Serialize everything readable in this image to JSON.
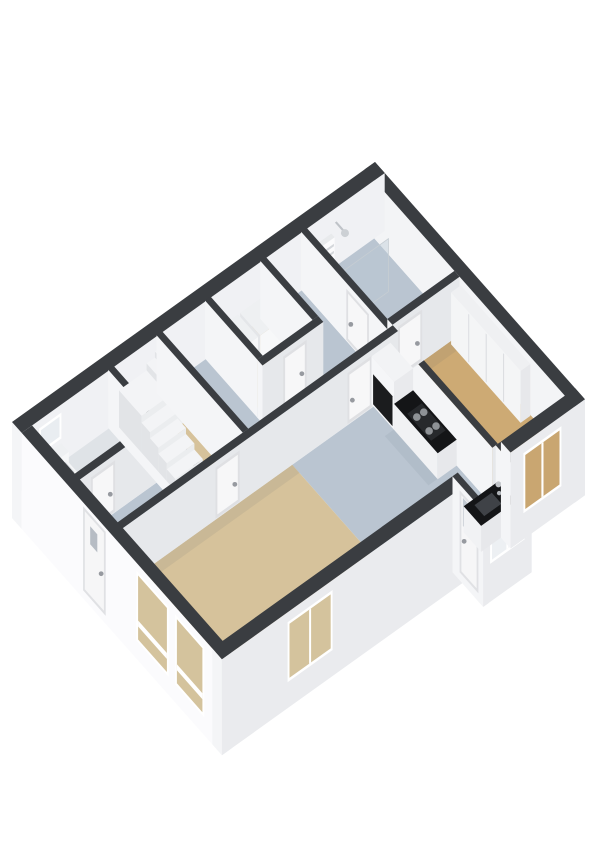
{
  "meta": {
    "label": "3D floor plan, isometric view"
  },
  "projection": {
    "ox": 12,
    "oy": 422,
    "ax": 34.57,
    "ay": -24.76,
    "bx": 32.3,
    "by": 36.5,
    "floor": 58,
    "ground": 96
  },
  "colors": {
    "background": "#ffffff",
    "wallTop": "#3a3d41",
    "faceL": "#f4f5f7",
    "faceR": "#e6e8eb",
    "exteriorWhite": "#fbfbfd",
    "floorWood": "#d6c29b",
    "floorWoodDark": "#cdaa74",
    "floorBlueGray": "#bac5d1",
    "floorGray": "#dfe3e7",
    "counterBlack": "#141517",
    "applianceBlack": "#1b1c1e",
    "glassTan": "#d4c39d",
    "glassTanDark": "#c9a671",
    "glassWhite": "#edf0f3",
    "doorPanel": "#f7f7f8",
    "doorFrame": "#dfe0e3",
    "windowFrame": "#ffffff",
    "handle": "#979aa0"
  },
  "items": [
    {
      "t": "flat",
      "n": "floor-wc",
      "u0": 0.28,
      "v0": 0.28,
      "u1": 2.52,
      "v1": 1.62,
      "dy": 58,
      "f": "#dfe3e7"
    },
    {
      "t": "flat",
      "n": "floor-entry",
      "u0": 0.28,
      "v0": 1.78,
      "u1": 2.52,
      "v1": 2.95,
      "dy": 58,
      "f": "#bac5d1"
    },
    {
      "t": "flat",
      "n": "floor-stairwell",
      "u0": 2.68,
      "v0": 0.28,
      "u1": 3.92,
      "v1": 2.95,
      "dy": 58,
      "f": "#d6c29b"
    },
    {
      "t": "flat",
      "n": "floor-hall",
      "u0": 4.08,
      "v0": 0.28,
      "u1": 8.1,
      "v1": 2.95,
      "dy": 58,
      "f": "#bac5d1"
    },
    {
      "t": "flat",
      "n": "floor-utility",
      "u0": 5.48,
      "v0": 0.28,
      "u1": 6.92,
      "v1": 1.9,
      "dy": 58,
      "f": "#d6c29b"
    },
    {
      "t": "flat",
      "n": "floor-bathroom",
      "u0": 8.26,
      "v0": 0.28,
      "u1": 10.2,
      "v1": 2.78,
      "dy": 58,
      "f": "#bac5d1"
    },
    {
      "t": "flat",
      "n": "floor-kitchen",
      "u0": 5.2,
      "v0": 3.11,
      "u1": 8.1,
      "v1": 6.2,
      "dy": 58,
      "f": "#bac5d1"
    },
    {
      "t": "flat",
      "n": "floor-sink-bay",
      "u0": 7.1,
      "v0": 6.2,
      "u1": 8.2,
      "v1": 6.85,
      "dy": 58,
      "f": "#bac5d1"
    },
    {
      "t": "flat",
      "n": "floor-living",
      "u0": 0.28,
      "v0": 3.11,
      "u1": 5.2,
      "v1": 6.2,
      "dy": 58,
      "f": "#d6c29b"
    },
    {
      "t": "flat",
      "n": "floor-bedroom",
      "u0": 8.26,
      "v0": 2.94,
      "u1": 10.2,
      "v1": 6.2,
      "dy": 58,
      "f": "#cdaa74"
    },
    {
      "t": "flat",
      "n": "shadow-living-north",
      "u0": 0.28,
      "v0": 3.11,
      "u1": 5.2,
      "v1": 3.34,
      "dy": 57.5,
      "f": "rgba(75,85,105,0.09)"
    },
    {
      "t": "flat",
      "n": "shadow-bedroom-north",
      "u0": 8.26,
      "v0": 2.94,
      "u1": 10.2,
      "v1": 3.18,
      "dy": 57.5,
      "f": "rgba(75,85,105,0.09)"
    },
    {
      "t": "flat",
      "n": "shadow-bath-west",
      "u0": 8.26,
      "v0": 0.28,
      "u1": 8.48,
      "v1": 2.78,
      "dy": 57.5,
      "f": "rgba(75,85,105,0.07)"
    },
    {
      "t": "flat",
      "n": "shadow-kitchen-counter",
      "u0": 7.28,
      "v0": 3.75,
      "u1": 7.55,
      "v1": 5.1,
      "dy": 57.5,
      "f": "rgba(75,85,105,0.07)"
    },
    {
      "t": "box",
      "n": "wall-ne",
      "u0": 10.2,
      "v0": 0,
      "u1": 10.5,
      "v1": 6.5,
      "bl": 58,
      "br": 96,
      "cl": "#f3f4f6"
    },
    {
      "t": "box",
      "n": "wall-nw",
      "u0": 0,
      "v0": 0,
      "u1": 10.5,
      "v1": 0.3,
      "bl": 96,
      "br": 58,
      "cr": "#f0f1f4"
    },
    {
      "t": "fV",
      "n": "window-wc",
      "v": 0.3,
      "a0": 0.5,
      "a1": 1.15,
      "y0": 8,
      "y1": 34,
      "fr": "#ffffff",
      "f": "#e9edf1"
    },
    {
      "t": "flat",
      "n": "shower-arm",
      "u0": 9.06,
      "v0": 0.3,
      "u1": 9.11,
      "v1": 0.54,
      "dy": 14,
      "f": "#bfc3c8"
    },
    {
      "t": "dot",
      "n": "shower-head",
      "u": 9.09,
      "v": 0.58,
      "dy": 15,
      "r": 4,
      "f": "#ccd0d4"
    },
    {
      "t": "box",
      "n": "toilet-cistern",
      "u0": 0.55,
      "v0": 0.34,
      "u1": 1.1,
      "v1": 0.58,
      "top": 36,
      "bl": 54,
      "br": 54,
      "ct": "#eef0f2",
      "cl": "#e3e5e8",
      "cr": "#f6f7f8"
    },
    {
      "t": "box",
      "n": "toilet-bowl",
      "u0": 0.62,
      "v0": 0.58,
      "u1": 1.03,
      "v1": 0.94,
      "top": 42,
      "bl": 56,
      "br": 56,
      "ct": "#f4f5f6",
      "cl": "#e6e8ea",
      "cr": "#fbfbfc"
    },
    {
      "t": "flat",
      "n": "toilet-seat",
      "u0": 0.68,
      "v0": 0.62,
      "u1": 0.97,
      "v1": 0.9,
      "dy": 41.5,
      "f": "#d4d7db"
    },
    {
      "t": "box",
      "n": "wall-wc-south",
      "u0": 0.28,
      "v0": 1.62,
      "u1": 2.52,
      "v1": 1.78
    },
    {
      "t": "fV",
      "n": "door-wc",
      "v": 1.78,
      "a0": 0.62,
      "a1": 1.32,
      "y0": 6,
      "y1": 57,
      "fr": "#dfe0e3",
      "f": "#f7f7f8",
      "h": "e"
    },
    {
      "t": "box",
      "n": "wall-stairs-west",
      "u0": 2.52,
      "v0": 0.28,
      "u1": 2.68,
      "v1": 2.95
    },
    {
      "t": "box",
      "n": "dryer",
      "u0": 6.28,
      "v0": 0.34,
      "u1": 6.88,
      "v1": 0.96,
      "top": 34,
      "ct": "#eef0f2",
      "cl": "#e4e6e9",
      "cr": "#f7f8f9"
    },
    {
      "t": "box",
      "n": "washer",
      "u0": 5.62,
      "v0": 0.34,
      "u1": 6.22,
      "v1": 0.96,
      "top": 34,
      "ct": "#eef0f2",
      "cl": "#e4e6e9",
      "cr": "#f7f8f9"
    },
    {
      "t": "box",
      "n": "wall-utility-west",
      "u0": 5.32,
      "v0": 0.28,
      "u1": 5.48,
      "v1": 1.9
    },
    {
      "t": "box",
      "n": "wall-utility-east",
      "u0": 6.92,
      "v0": 0.28,
      "u1": 7.08,
      "v1": 1.9
    },
    {
      "t": "box",
      "n": "wall-utility-south",
      "u0": 5.32,
      "v0": 1.9,
      "u1": 7.08,
      "v1": 2.06
    },
    {
      "t": "fV",
      "n": "door-utility",
      "v": 2.06,
      "a0": 5.92,
      "a1": 6.6,
      "y0": 6,
      "y1": 57,
      "fr": "#dfe0e3",
      "f": "#f7f7f8",
      "h": "e"
    },
    {
      "t": "box",
      "n": "stair-winder-2",
      "u0": 3.76,
      "v0": 0.4,
      "u1": 4.0,
      "v1": 1.1,
      "top": 8,
      "ct": "#f3f4f6",
      "cl": "#e2e4e7",
      "cr": "#ebedef"
    },
    {
      "t": "box",
      "n": "stair-winder-1",
      "u0": 3.52,
      "v0": 0.4,
      "u1": 3.76,
      "v1": 1.1,
      "top": 14,
      "ct": "#f3f4f6",
      "cl": "#e2e4e7",
      "cr": "#ebedef"
    },
    {
      "t": "box",
      "n": "stair-landing",
      "u0": 2.72,
      "v0": 0.4,
      "u1": 3.52,
      "v1": 1.1,
      "top": 21,
      "ct": "#f3f4f6",
      "cl": "#e2e4e7",
      "cr": "#ebedef"
    },
    {
      "t": "box",
      "n": "stair-step-5",
      "u0": 2.72,
      "v0": 1.1,
      "u1": 3.52,
      "v1": 1.36,
      "top": 28,
      "ct": "#f3f4f6",
      "cl": "#e2e4e7",
      "cr": "#ebedef"
    },
    {
      "t": "box",
      "n": "stair-step-4",
      "u0": 2.72,
      "v0": 1.36,
      "u1": 3.52,
      "v1": 1.62,
      "top": 34,
      "ct": "#f3f4f6",
      "cl": "#e2e4e7",
      "cr": "#ebedef"
    },
    {
      "t": "box",
      "n": "stair-step-3",
      "u0": 2.72,
      "v0": 1.62,
      "u1": 3.52,
      "v1": 1.88,
      "top": 40,
      "ct": "#f3f4f6",
      "cl": "#e2e4e7",
      "cr": "#ebedef"
    },
    {
      "t": "box",
      "n": "stair-step-2",
      "u0": 2.72,
      "v0": 1.88,
      "u1": 3.52,
      "v1": 2.14,
      "top": 46,
      "ct": "#f3f4f6",
      "cl": "#e2e4e7",
      "cr": "#ebedef"
    },
    {
      "t": "box",
      "n": "stair-step-1",
      "u0": 2.72,
      "v0": 2.14,
      "u1": 3.52,
      "v1": 2.4,
      "top": 52,
      "ct": "#f3f4f6",
      "cl": "#e2e4e7",
      "cr": "#ebedef"
    },
    {
      "t": "box",
      "n": "wall-stairs-east",
      "u0": 3.92,
      "v0": 0.28,
      "u1": 4.08,
      "v1": 2.95
    },
    {
      "t": "box",
      "n": "towel-radiator",
      "u0": 8.32,
      "v0": 0.34,
      "u1": 8.92,
      "v1": 0.44,
      "top": 20,
      "bl": 54,
      "br": 54,
      "ct": "#e8eaec",
      "cl": "#eff0f2",
      "cr": "#fbfbfc"
    },
    {
      "t": "fV",
      "n": "radiator-rung-1",
      "v": 0.44,
      "a0": 8.34,
      "a1": 8.9,
      "y0": 26,
      "y1": 28.5,
      "f": "#d4d7db"
    },
    {
      "t": "fV",
      "n": "radiator-rung-2",
      "v": 0.44,
      "a0": 8.34,
      "a1": 8.9,
      "y0": 33,
      "y1": 35.5,
      "f": "#d4d7db"
    },
    {
      "t": "fV",
      "n": "radiator-rung-3",
      "v": 0.44,
      "a0": 8.34,
      "a1": 8.9,
      "y0": 40,
      "y1": 42.5,
      "f": "#d4d7db"
    },
    {
      "t": "fV",
      "n": "shower-glass",
      "v": 1.38,
      "a0": 8.34,
      "a1": 9.6,
      "y0": 4,
      "y1": 57,
      "f": "rgba(186,200,212,0.42)",
      "st": "#c6cdd3"
    },
    {
      "t": "box",
      "n": "wall-bath-west",
      "u0": 8.1,
      "v0": 0.28,
      "u1": 8.26,
      "v1": 6.2
    },
    {
      "t": "fU",
      "n": "door-bathroom",
      "u": 8.1,
      "a0": 1.68,
      "a1": 2.38,
      "y0": 6,
      "y1": 57,
      "fr": "#dfe0e3",
      "f": "#f7f7f8",
      "h": "s"
    },
    {
      "t": "box",
      "n": "wall-bedroom-north",
      "u0": 8.26,
      "v0": 2.78,
      "u1": 10.2,
      "v1": 2.94
    },
    {
      "t": "fV",
      "n": "door-bedroom",
      "v": 2.94,
      "a0": 8.42,
      "a1": 9.12,
      "y0": 6,
      "y1": 57,
      "fr": "#dfe0e3",
      "f": "#f7f7f8",
      "h": "e"
    },
    {
      "t": "box",
      "n": "wardrobe",
      "u0": 9.9,
      "v0": 3.0,
      "u1": 10.18,
      "v1": 5.15,
      "top": 6,
      "ct": "#eff0f2",
      "cl": "#f4f5f6",
      "cr": "#e7e8eb"
    },
    {
      "t": "fU",
      "n": "wardrobe-seam-1",
      "u": 9.9,
      "a0": 3.53,
      "a1": 3.56,
      "y0": 8,
      "y1": 56,
      "f": "#d9dbdf"
    },
    {
      "t": "fU",
      "n": "wardrobe-seam-2",
      "u": 9.9,
      "a0": 4.07,
      "a1": 4.1,
      "y0": 8,
      "y1": 56,
      "f": "#d9dbdf"
    },
    {
      "t": "fU",
      "n": "wardrobe-seam-3",
      "u": 9.9,
      "a0": 4.61,
      "a1": 4.64,
      "y0": 8,
      "y1": 56,
      "f": "#d9dbdf"
    },
    {
      "t": "box",
      "n": "wall-hall-south",
      "u0": 0.28,
      "v0": 2.95,
      "u1": 8.26,
      "v1": 3.11
    },
    {
      "t": "fV",
      "n": "door-living",
      "v": 3.11,
      "a0": 2.98,
      "a1": 3.68,
      "y0": 6,
      "y1": 57,
      "fr": "#dfe0e3",
      "f": "#f7f7f8",
      "h": "e"
    },
    {
      "t": "fV",
      "n": "door-kitchen",
      "v": 3.11,
      "a0": 6.8,
      "a1": 7.5,
      "y0": 6,
      "y1": 57,
      "fr": "#dfe0e3",
      "f": "#f7f7f8",
      "h": "s"
    },
    {
      "t": "box",
      "n": "kitchen-tall-cabinet",
      "u0": 7.55,
      "v0": 3.05,
      "u1": 8.1,
      "v1": 3.75,
      "top": 10,
      "ct": "#f2f3f5",
      "cl": "#f5f6f8",
      "cr": "#e9eaed"
    },
    {
      "t": "fU",
      "n": "oven-front",
      "u": 7.55,
      "a0": 3.1,
      "a1": 3.7,
      "y0": 26,
      "y1": 56,
      "f": "#1b1c1e"
    },
    {
      "t": "box",
      "n": "kitchen-counter",
      "u0": 7.55,
      "v0": 3.75,
      "u1": 8.1,
      "v1": 5.1,
      "top": 32,
      "ct": "#141517",
      "cl": "#f1f2f4",
      "cr": "#e7e8eb"
    },
    {
      "t": "flat",
      "n": "cooktop",
      "u0": 7.62,
      "v0": 4.08,
      "u1": 8.04,
      "v1": 4.82,
      "dy": 31.5,
      "f": "#27292c"
    },
    {
      "t": "dot",
      "n": "burner-1",
      "u": 7.73,
      "v": 4.26,
      "dy": 31,
      "r": 3.8,
      "f": "#8e9296"
    },
    {
      "t": "dot",
      "n": "burner-2",
      "u": 7.73,
      "v": 4.64,
      "dy": 31,
      "r": 3.8,
      "f": "#8e9296"
    },
    {
      "t": "dot",
      "n": "burner-3",
      "u": 7.93,
      "v": 4.26,
      "dy": 31,
      "r": 3.8,
      "f": "#8e9296"
    },
    {
      "t": "dot",
      "n": "burner-4",
      "u": 7.93,
      "v": 4.64,
      "dy": 31,
      "r": 3.8,
      "f": "#8e9296"
    },
    {
      "t": "box",
      "n": "wall-sw",
      "u0": 0,
      "v0": 0.3,
      "u1": 0.3,
      "v1": 6.5,
      "bl": 96,
      "br": 96,
      "cl": "#fbfbfd"
    },
    {
      "t": "fU",
      "n": "door-front",
      "u": 0,
      "a0": 2.2,
      "a1": 2.9,
      "y0": 4,
      "y1": 88,
      "fr": "#e0e1e4",
      "f": "#f6f6f7",
      "gl": [
        2.42,
        2.64,
        16,
        34,
        "#b6bcc4"
      ],
      "h": "e"
    },
    {
      "t": "fU",
      "n": "window-living-sw-1",
      "u": 0,
      "a0": 3.85,
      "a1": 4.85,
      "y0": 8,
      "y1": 78,
      "fr": "#ffffff",
      "f": "#d4c39d",
      "tr": [
        56,
        62
      ]
    },
    {
      "t": "fU",
      "n": "window-living-sw-2",
      "u": 0,
      "a0": 5.05,
      "a1": 5.95,
      "y0": 8,
      "y1": 78,
      "fr": "#ffffff",
      "f": "#d4c39d",
      "tr": [
        56,
        62
      ]
    },
    {
      "t": "box",
      "n": "wall-se-west",
      "u0": 0,
      "v0": 6.2,
      "u1": 6.95,
      "v1": 6.5,
      "bl": 96,
      "br": 96,
      "cr": "#eaebee"
    },
    {
      "t": "fV",
      "n": "window-living-se",
      "v": 6.5,
      "a0": 1.9,
      "a1": 3.2,
      "y0": 10,
      "y1": 70,
      "fr": "#ffffff",
      "f": "#d4c39d",
      "m": 1
    },
    {
      "t": "box",
      "n": "bay-wall-west",
      "u0": 6.95,
      "v0": 6.2,
      "u1": 7.1,
      "v1": 7.15,
      "bl": 96,
      "br": 96
    },
    {
      "t": "box",
      "n": "bay-wall-front",
      "u0": 6.95,
      "v0": 6.85,
      "u1": 8.35,
      "v1": 7.15,
      "bl": 96,
      "br": 96,
      "cr": "#eaebee"
    },
    {
      "t": "box",
      "n": "bay-wall-east",
      "u0": 8.2,
      "v0": 6.2,
      "u1": 8.35,
      "v1": 7.15,
      "bl": 58,
      "br": 96,
      "cr": "#eaebee"
    },
    {
      "t": "fU",
      "n": "door-back",
      "u": 6.95,
      "a0": 6.42,
      "a1": 7.0,
      "y0": 6,
      "y1": 88,
      "fr": "#e0e1e4",
      "f": "#f6f6f7",
      "gl": [
        6.52,
        6.9,
        10,
        38,
        "#c3cad2"
      ],
      "h": "s"
    },
    {
      "t": "fV",
      "n": "window-bay",
      "v": 7.15,
      "a0": 7.15,
      "a1": 8.15,
      "y0": 8,
      "y1": 58,
      "fr": "#ffffff",
      "f": "#edf0f3",
      "m": 1
    },
    {
      "t": "box",
      "n": "sink-counter",
      "u0": 7.18,
      "v0": 6.3,
      "u1": 8.18,
      "v1": 6.84,
      "top": 32,
      "ct": "#141517",
      "cl": "#f1f2f4",
      "cr": "#e7e8eb"
    },
    {
      "t": "flat",
      "n": "sink-basin",
      "u0": 7.38,
      "v0": 6.42,
      "u1": 7.88,
      "v1": 6.72,
      "dy": 31.5,
      "f": "#3f4247"
    },
    {
      "t": "dot",
      "n": "faucet",
      "u": 7.98,
      "v": 6.52,
      "dy": 22,
      "r": 3,
      "f": "#c2c5c9"
    },
    {
      "t": "dot",
      "n": "faucet-base",
      "u": 7.98,
      "v": 6.54,
      "dy": 30,
      "r": 2.2,
      "f": "#aeb2b7"
    },
    {
      "t": "box",
      "n": "wall-se-east",
      "u0": 8.35,
      "v0": 6.2,
      "u1": 10.5,
      "v1": 6.5,
      "bl": 96,
      "br": 96,
      "cr": "#eaebee"
    },
    {
      "t": "fV",
      "n": "window-bedroom",
      "v": 6.5,
      "a0": 8.72,
      "a1": 9.82,
      "y0": 10,
      "y1": 70,
      "fr": "#ffffff",
      "f": "#c9a671",
      "m": 1
    }
  ]
}
